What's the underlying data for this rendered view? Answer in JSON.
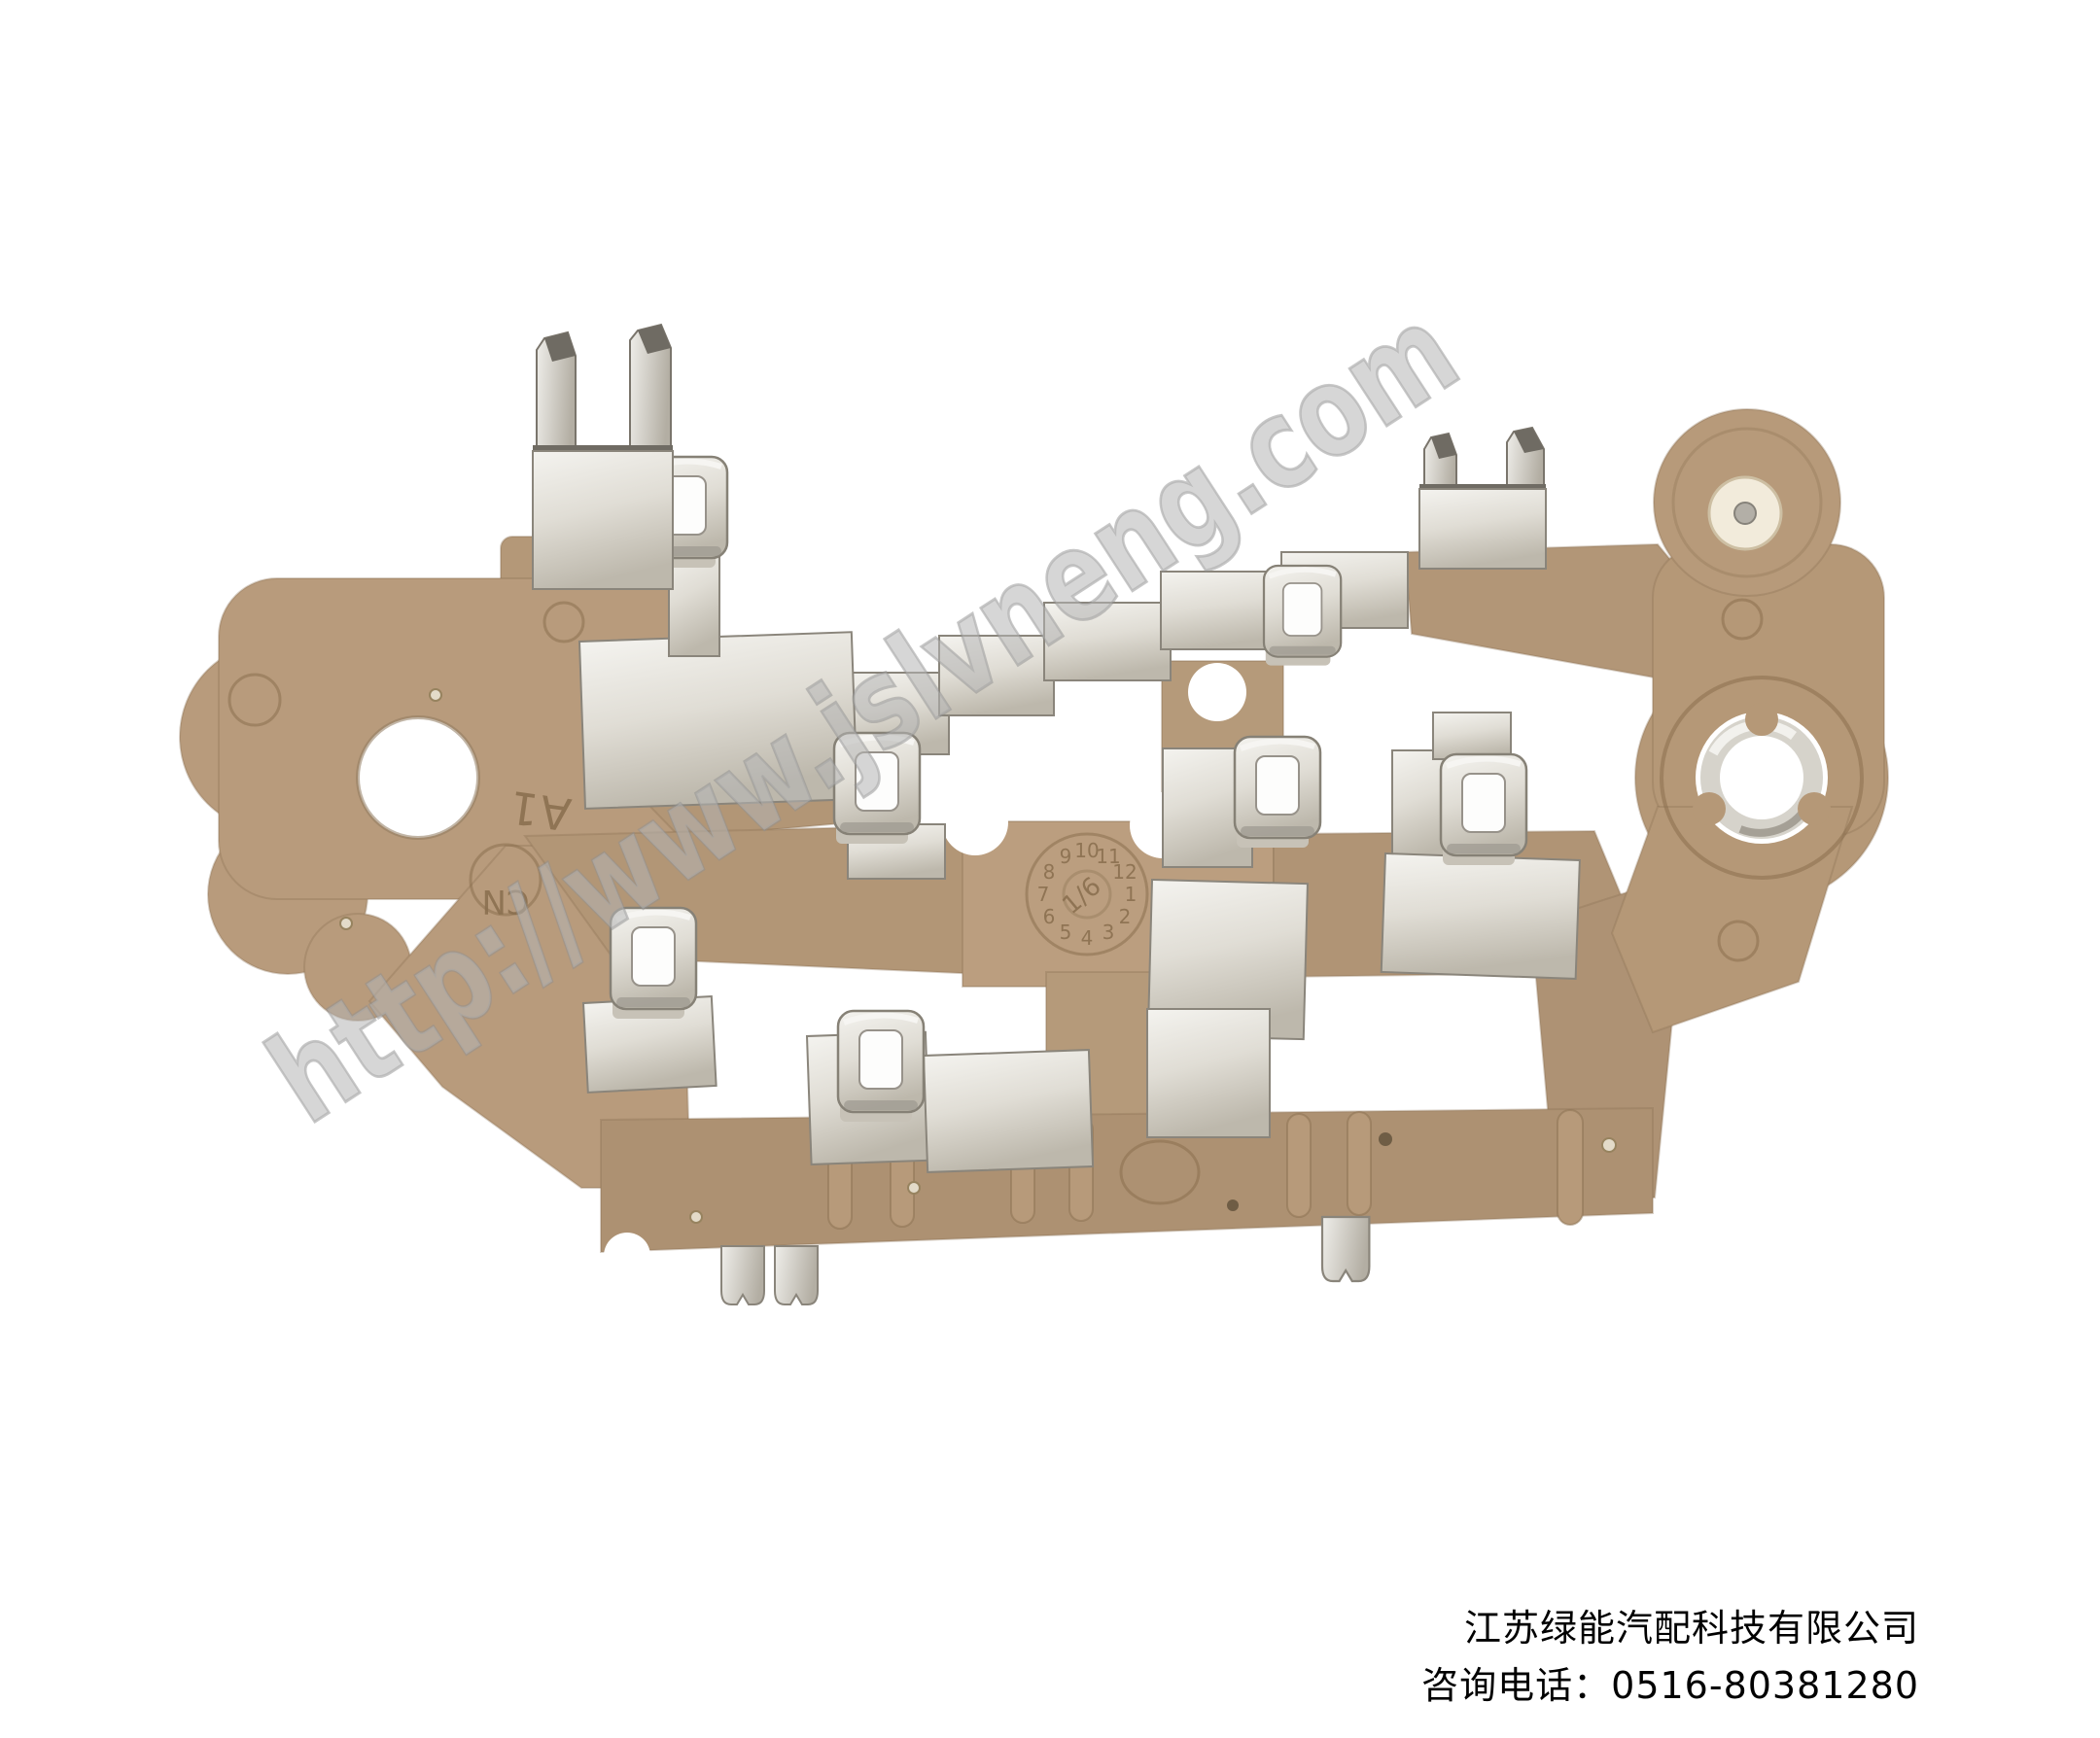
{
  "photo": {
    "background": "#ffffff",
    "subject": "tan plastic alternator terminal plate with metal spring clips and fork terminals"
  },
  "watermark": {
    "text": "http://www.jslvneng.com",
    "color": "#a8a8a8",
    "angle_deg": -33
  },
  "caption": {
    "company": "江苏绿能汽配科技有限公司",
    "phone": "咨询电话：0516-80381280",
    "text_color": "#000000"
  },
  "part": {
    "plastic_color": "#b49878",
    "metal_color": "#dedbd3",
    "markings": {
      "a1": "A1",
      "cn": "CN",
      "date_wheel": {
        "numbers": [
          "1",
          "2",
          "3",
          "4",
          "5",
          "6",
          "7",
          "8",
          "9",
          "10",
          "11",
          "12"
        ],
        "center": "1/6"
      }
    }
  }
}
